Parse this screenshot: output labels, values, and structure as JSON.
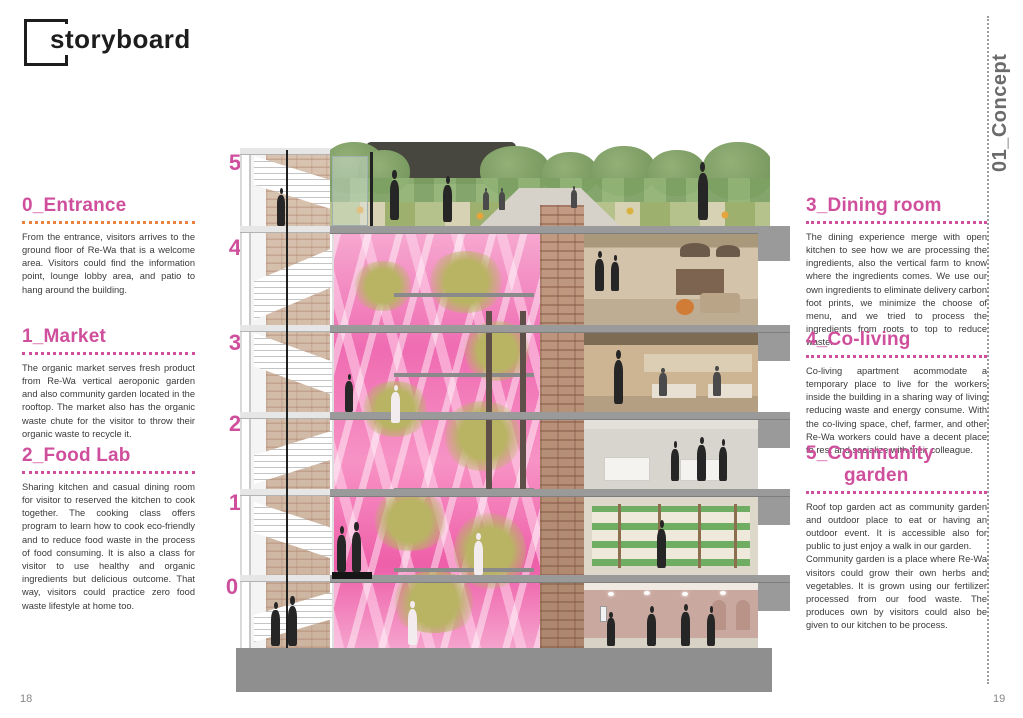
{
  "page": {
    "title": "storyboard",
    "chapter_label": "01_Concept",
    "page_left": "18",
    "page_right": "19"
  },
  "colors": {
    "accent_pink": "#cf4f9d",
    "accent_orange": "#e8823f",
    "chapter_gray": "#6b6b6b"
  },
  "floors": [
    "5",
    "4",
    "3",
    "2",
    "1",
    "0"
  ],
  "sections_left": [
    {
      "title": "0_Entrance",
      "body": "From the entrance, visitors arrives to the ground floor of Re-Wa that is a welcome area. Visitors could find the information point, lounge lobby area, and patio to hang around the building."
    },
    {
      "title": "1_Market",
      "body": "The organic market serves fresh product from Re-Wa vertical aeroponic garden and also community garden located in the rooftop. The market also has the organic waste chute for the visitor to throw their organic waste to recycle it."
    },
    {
      "title": "2_Food Lab",
      "body": "Sharing kitchen and casual dining room for visitor to reserved the kitchen to cook together. The cooking class offers program to learn how to cook eco-friendly and to reduce food waste in the process of food consuming. It is also a class for visitor to use healthy and organic ingredients but delicious outcome. That way, visitors could practice zero food waste lifestyle at home too."
    }
  ],
  "sections_right": [
    {
      "title": "3_Dining room",
      "body": "The dining experience merge with open kitchen to see how we are processing the ingredients, also the vertical farm to know where the ingredients comes. We use our own ingredients to eliminate delivery carbon foot prints, we minimize the choose of menu, and we tried to process the ingredients from roots to top to reduce waste."
    },
    {
      "title": "4_Co-living",
      "body": "Co-living apartment acommodate a temporary place to live for the workers inside the building in a sharing way of living reducing waste and energy consume. With the co-living space, chef, farmer, and other Re-Wa workers could have a decent place to rest and socialize with their colleague."
    },
    {
      "title": "5_Community",
      "title2": "garden",
      "body": "Roof top garden act as community garden and outdoor place to eat or having an outdoor event. It is accessible also for public to just enjoy a walk in our garden.\nCommunity garden is a place where Re-Wa visitors could grow their own herbs and vegetables. It is grown using our fertilizer processed from our food waste. The produces own by visitors could also be given to our kitchen to be process."
    }
  ]
}
